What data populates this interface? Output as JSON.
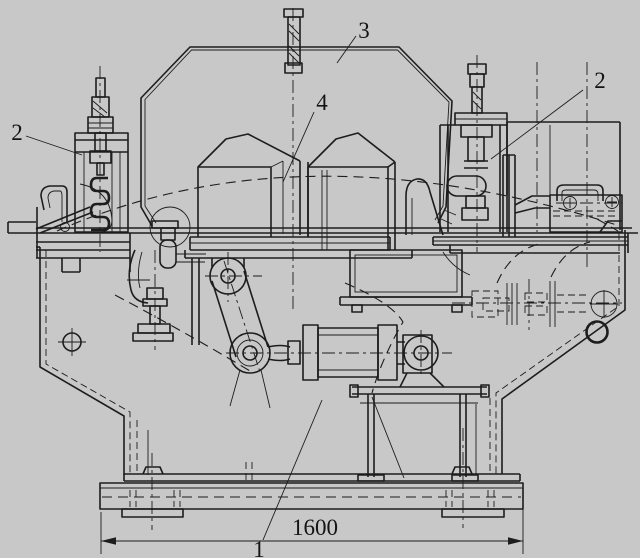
{
  "drawing": {
    "kind": "engineering-assembly-elevation",
    "background_color": "#c8c8c8",
    "ink_color": "#1d1d1d",
    "callouts": {
      "part1": "1",
      "part2_left": "2",
      "part2_right": "2",
      "part3": "3",
      "part4": "4"
    },
    "dimension": {
      "width_value": "1600"
    }
  }
}
